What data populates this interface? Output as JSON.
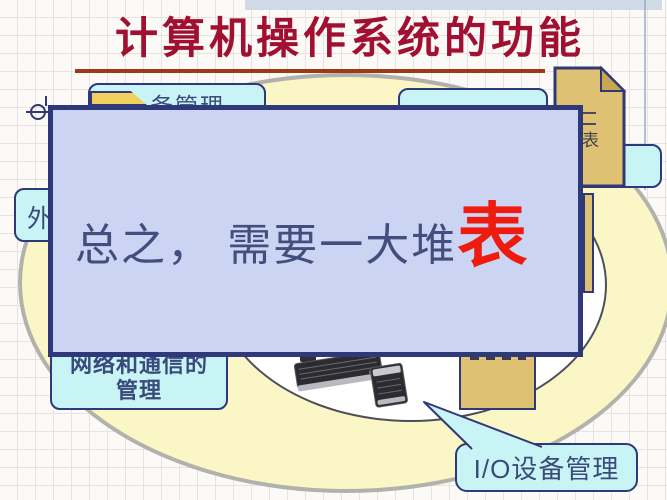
{
  "slide": {
    "title": "计算机操作系统的功能",
    "title_color": "#a21031",
    "underline_color": "#9c3a14"
  },
  "overlay": {
    "text_normal": "总之， 需要一大堆",
    "text_emphasis": "表",
    "text_color": "#424e7e",
    "emphasis_color": "#ed1c0f",
    "fill": "#ccd4f3",
    "border": "#2f3878"
  },
  "boxes": {
    "top_left": {
      "visible_text": "务管理"
    },
    "left": {
      "visible_text": "外"
    },
    "network": {
      "line1": "网络和通信的",
      "line2": "管理"
    },
    "callout": {
      "label": "I/O设备管理"
    }
  },
  "documents": {
    "top_right": {
      "visible_text": "表"
    }
  },
  "icons": {
    "folder_icon": "folder-tab",
    "document_icon": "dog-ear-document",
    "keyboard_image": "keyboard-with-numpad-photo",
    "anchor_icon": "circle-crosshair"
  },
  "colors": {
    "box_fill": "#c9f4f6",
    "box_border": "#2f3878",
    "document_fill": "#dfc173",
    "ellipse_fill": "#faf6c6",
    "ellipse_border": "#b2b2ac",
    "inner_ellipse_fill": "#ffffff"
  }
}
